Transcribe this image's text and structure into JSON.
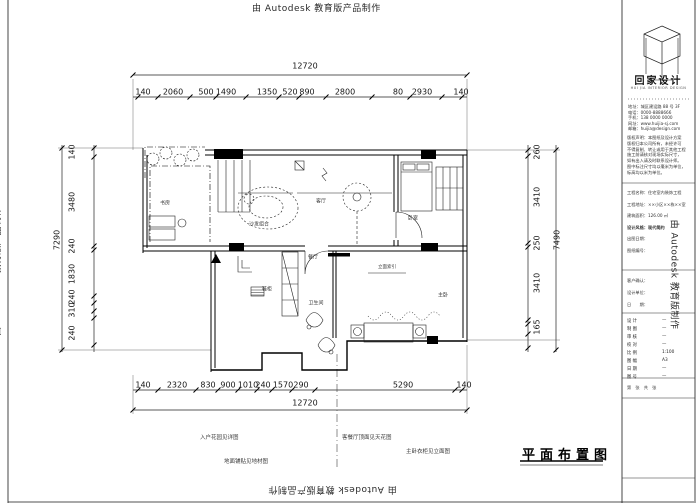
{
  "watermark": {
    "top": "由 Autodesk 教育版产品制作",
    "bottom": "由 Autodesk 教育版产品制作",
    "left": "由 Autodesk 教育版产品制作",
    "right": "由 Autodesk 教育版制作"
  },
  "drawing_title": "平面布置图",
  "dims": {
    "top_overall": "12720",
    "bottom_overall": "12720",
    "left_overall": "7290",
    "right_overall": "7490",
    "top": [
      "140",
      "2060",
      "500",
      "1490",
      "1350",
      "520",
      "890",
      "2800",
      "80",
      "2930",
      "140"
    ],
    "bottom": [
      "140",
      "2320",
      "830",
      "900",
      "1010",
      "240",
      "1570",
      "290",
      "5290",
      "140"
    ],
    "left": [
      "140",
      "3480",
      "240",
      "1830",
      "240",
      "310",
      "240"
    ],
    "right": [
      "260",
      "3410",
      "250",
      "3410",
      "165"
    ]
  },
  "rooms": {
    "study": "书房",
    "living": "客厅",
    "bedroom": "卧室",
    "dining": "餐厅",
    "master": "主卧",
    "bath": "卫生间",
    "sofa": "沙发组合",
    "shoe": "鞋柜",
    "index": "立面索引"
  },
  "notes": [
    "入户花园见详图",
    "客餐厅顶面见天花图",
    "主卧衣柜见立面图",
    "地面铺贴见地材图"
  ],
  "titleblock": {
    "brand": "回家设计",
    "brand_en": "HUI JIA INTERIOR DESIGN",
    "contact": [
      "地址：城区建设路 88 号 3F",
      "电话：0000-8888666",
      "手机：138 0000 0000",
      "网址：www.huijia-sj.com",
      "邮箱：huijia@design.com"
    ],
    "notice": [
      "版权声明：本图纸及设计方案",
      "版权归本公司所有，未经许可",
      "不得复制、转让或用于其他工程",
      "施工前请核对现场实际尺寸，",
      "如有出入请及时联系设计师。",
      "图中标注尺寸均以毫米为单位，",
      "标高均以米为单位。"
    ],
    "project": [
      "工程名称：住宅室内装饰工程",
      "工程地址：××小区××栋××室",
      "建筑面积：126.00 ㎡",
      "设计风格：现代简约",
      "出图日期：",
      "图纸编号："
    ],
    "confirm": [
      "客户确认：",
      "设计单位：",
      "日　　期："
    ],
    "fields": [
      {
        "label": "设 计",
        "value": "—"
      },
      {
        "label": "制 图",
        "value": "—"
      },
      {
        "label": "审 核",
        "value": "—"
      },
      {
        "label": "校 对",
        "value": "—"
      },
      {
        "label": "比 例",
        "value": "1:100"
      },
      {
        "label": "图 幅",
        "value": "A3"
      },
      {
        "label": "日 期",
        "value": "—"
      },
      {
        "label": "图 号",
        "value": "—"
      }
    ],
    "footer": "第　张　共　张"
  }
}
